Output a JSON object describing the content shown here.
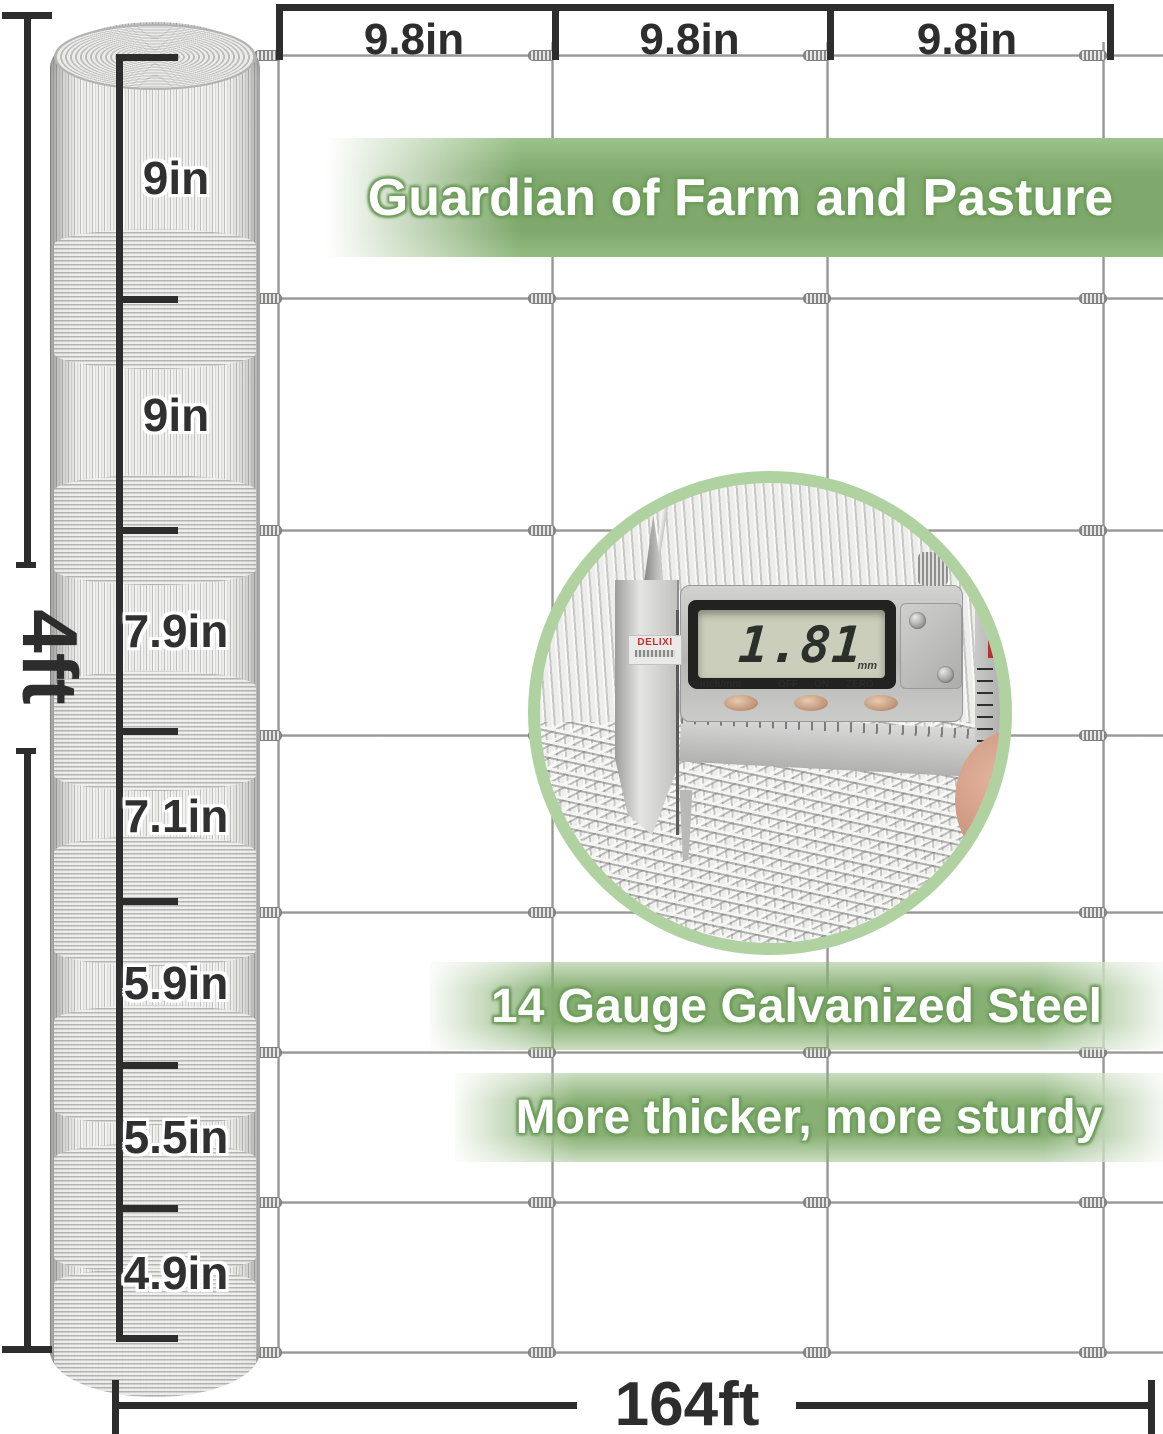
{
  "banner": {
    "title": "Guardian of Farm and Pasture"
  },
  "features": [
    {
      "text": "14 Gauge Galvanized Steel"
    },
    {
      "text": "More thicker, more sturdy"
    }
  ],
  "dimensions": {
    "height_label": "4ft",
    "length_label": "164ft",
    "top_spacings": [
      "9.8in",
      "9.8in",
      "9.8in"
    ],
    "roll_spacings": [
      "9in",
      "9in",
      "7.9in",
      "7.1in",
      "5.9in",
      "5.5in",
      "4.9in"
    ]
  },
  "caliper": {
    "reading": "1.81",
    "unit": "mm",
    "labels": [
      "inch/mm",
      "OFF",
      "ON",
      "ZERO"
    ],
    "brand": "DELIXI"
  },
  "colors": {
    "accent_green": "#7fa96c",
    "ring_green": "#b0d2a1",
    "dimension_dark": "#2d2d2d",
    "wire_gray": "#b5b5b3",
    "brand_red": "#c03330"
  }
}
